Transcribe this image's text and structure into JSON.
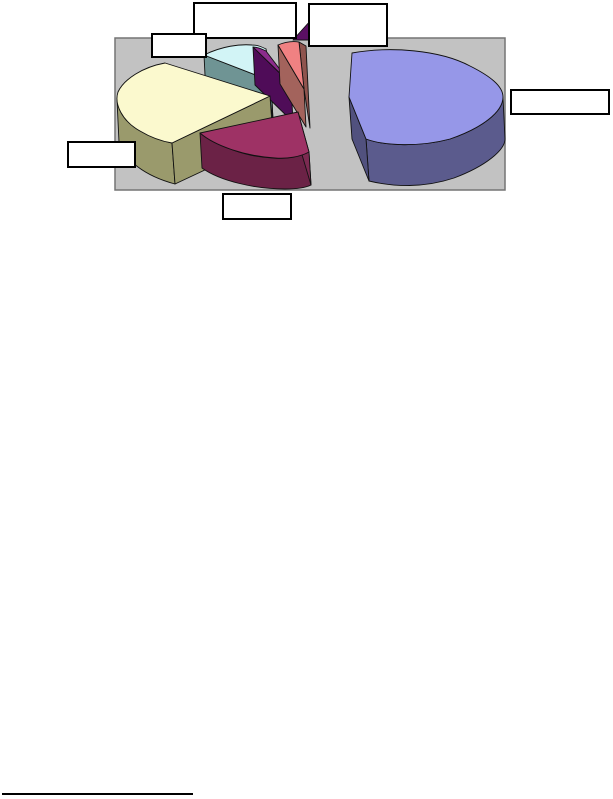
{
  "page": {
    "background": "#FFFFFF",
    "footnote_rule_present": true
  },
  "chart_data": {
    "type": "pie",
    "style": "3d-exploded-pie",
    "title": "",
    "xlabel": "",
    "ylabel": "",
    "legend": false,
    "plot_area_bg": "#C2C2C2",
    "plot_area_border": "#747474",
    "start_angle_deg": -90,
    "direction": "clockwise",
    "categories": [
      "slice-1",
      "slice-2",
      "slice-3",
      "slice-4",
      "slice-5",
      "slice-6"
    ],
    "values_pct": [
      40,
      20,
      26,
      9,
      2,
      3
    ],
    "series": [
      {
        "name": "slice-1-periwinkle",
        "label": "",
        "value_pct": 40,
        "color": "#9697E8",
        "side_color": "#5B5B8D",
        "cut_color": "#51517E"
      },
      {
        "name": "slice-2-plum",
        "label": "",
        "value_pct": 20,
        "color": "#9E3265",
        "side_color": "#6B2246",
        "cut_color": "#7C2A51"
      },
      {
        "name": "slice-3-ivory",
        "label": "",
        "value_pct": 26,
        "color": "#FBF9CE",
        "side_color": "#9A9A6C",
        "cut_color": "#9A9A6C"
      },
      {
        "name": "slice-4-cyan",
        "label": "",
        "value_pct": 9,
        "color": "#D2F4F6",
        "side_color": "#6F9494",
        "cut_color": "#5F8787"
      },
      {
        "name": "slice-5-purple",
        "label": "",
        "value_pct": 2,
        "color": "#8C2B8C",
        "side_color": "#4F0C58",
        "cut_color": "#5A0F63"
      },
      {
        "name": "slice-6-salmon",
        "label": "",
        "value_pct": 3,
        "color": "#F08182",
        "side_color": "#A3635C",
        "cut_color": "#8F544E"
      }
    ],
    "callouts": [
      {
        "id": "top-center",
        "label": "",
        "x": 193,
        "y": 2,
        "w": 104,
        "h": 37
      },
      {
        "id": "top-right",
        "label": "",
        "x": 308,
        "y": 3,
        "w": 80,
        "h": 44
      },
      {
        "id": "upper-left",
        "label": "",
        "x": 151,
        "y": 33,
        "w": 56,
        "h": 25
      },
      {
        "id": "right",
        "label": "",
        "x": 510,
        "y": 89,
        "w": 100,
        "h": 26
      },
      {
        "id": "left",
        "label": "",
        "x": 67,
        "y": 141,
        "w": 69,
        "h": 27
      },
      {
        "id": "bottom",
        "label": "",
        "x": 222,
        "y": 193,
        "w": 70,
        "h": 27
      }
    ],
    "notes": "All data-label callout boxes are empty white rectangles with black borders."
  }
}
